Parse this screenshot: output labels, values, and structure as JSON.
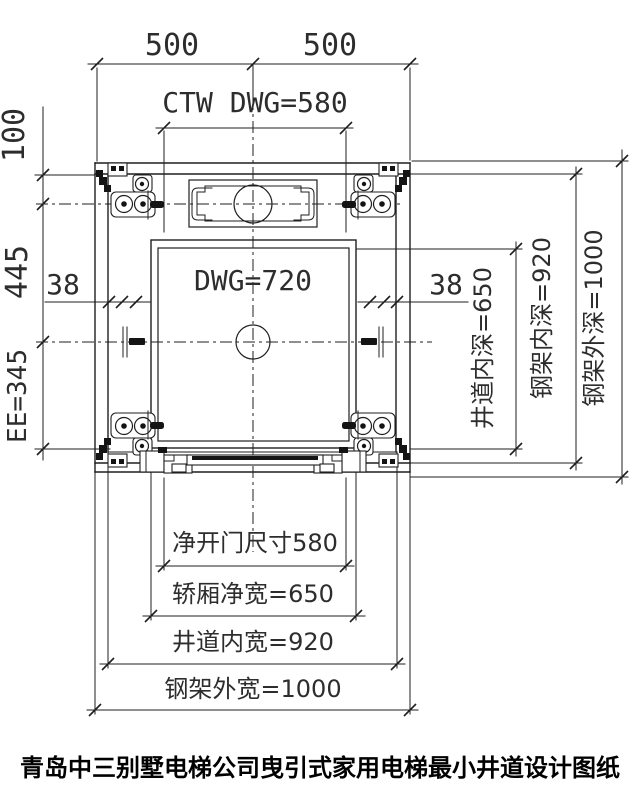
{
  "drawing": {
    "title": "青岛中三别墅电梯公司曳引式家用电梯最小井道设计图纸",
    "top": {
      "left_span": "500",
      "right_span": "500",
      "ctw_width": "CTW DWG=580"
    },
    "car": {
      "label": "DWG=720"
    },
    "left": {
      "top_offset": "100",
      "mid_span": "445",
      "bottom_span": "EE=345",
      "rail_gap": "38"
    },
    "right": {
      "rail_gap": "38",
      "shaft_inner_depth": "井道内深=650",
      "frame_inner_depth": "钢架内深=920",
      "frame_outer_depth": "钢架外深=1000"
    },
    "bottom": {
      "door_clear_width": "净开门尺寸580",
      "car_clear_width": "轿厢净宽=650",
      "shaft_inner_width": "井道内宽=920",
      "frame_outer_width": "钢架外宽=1000"
    }
  }
}
